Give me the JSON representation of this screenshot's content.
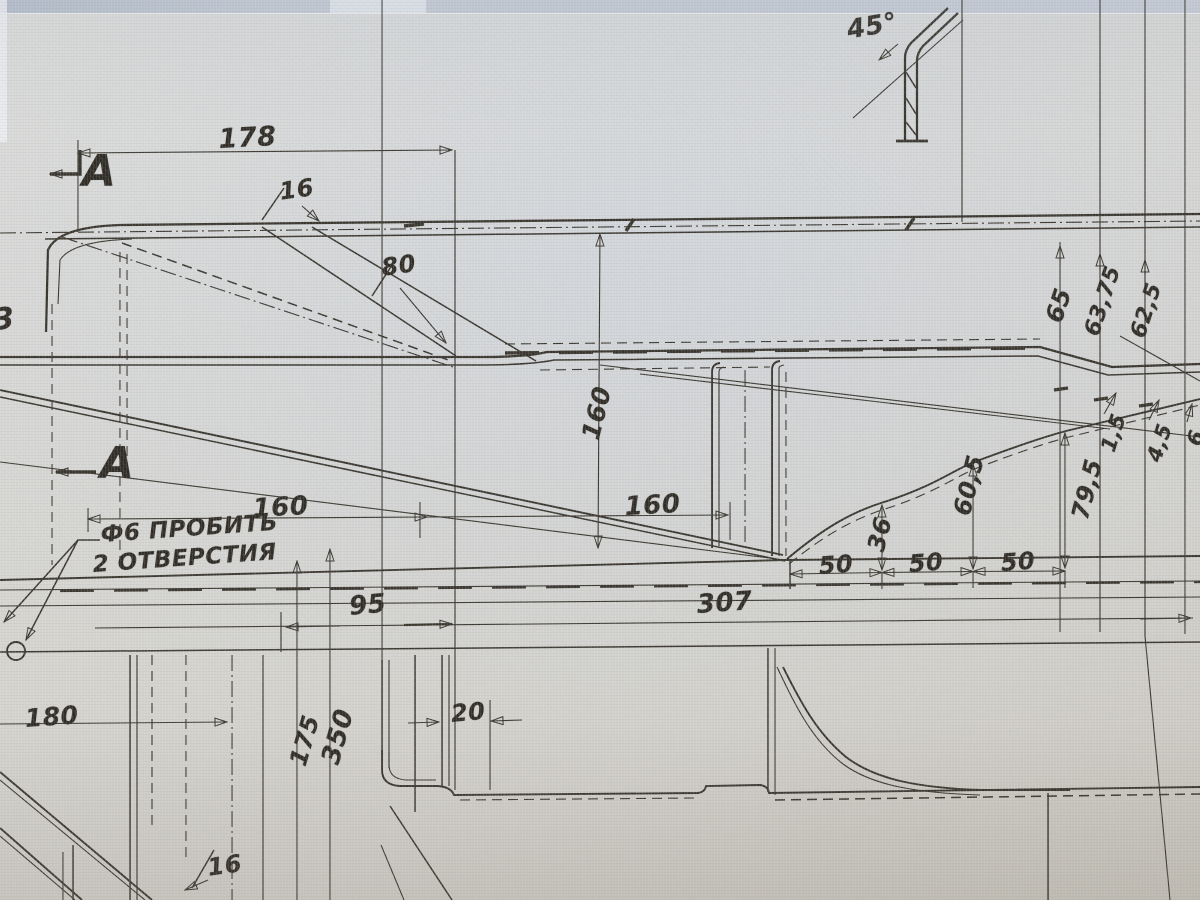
{
  "drawing": {
    "kind": "engineering-blueprint-photo",
    "note_line1": "Ф6 ПРОБИТЬ",
    "note_line2": "2 ОТВЕРСТИЯ",
    "section_label": "A",
    "angle_label": "45°"
  },
  "colors": {
    "paper": "#d8d7d2",
    "ink": "#39352d",
    "band": "#c2c9d2",
    "label": "#2f2b24"
  },
  "annotations": [
    {
      "text": "178",
      "x": 218,
      "y": 126,
      "rot": -3,
      "size": 27
    },
    {
      "text": "16",
      "x": 278,
      "y": 180,
      "rot": -8,
      "size": 24
    },
    {
      "text": "80",
      "x": 380,
      "y": 256,
      "rot": -8,
      "size": 24
    },
    {
      "text": "45°",
      "x": 845,
      "y": 18,
      "rot": -10,
      "size": 26
    },
    {
      "text": "A",
      "x": 82,
      "y": 150,
      "rot": 0,
      "size": 44,
      "bold": true
    },
    {
      "text": "A",
      "x": 100,
      "y": 442,
      "rot": 0,
      "size": 44,
      "bold": true
    },
    {
      "text": "3",
      "x": -8,
      "y": 306,
      "rot": -5,
      "size": 30
    },
    {
      "text": "160",
      "x": 578,
      "y": 436,
      "rot": -76,
      "size": 25
    },
    {
      "text": "160",
      "x": 252,
      "y": 496,
      "rot": -3,
      "size": 26
    },
    {
      "text": "160",
      "x": 624,
      "y": 494,
      "rot": -3,
      "size": 26
    },
    {
      "text": "Ф6 ПРОБИТЬ",
      "x": 100,
      "y": 524,
      "rot": -4,
      "size": 23
    },
    {
      "text": "2 ОТВЕРСТИЯ",
      "x": 92,
      "y": 554,
      "rot": -4,
      "size": 23
    },
    {
      "text": "50",
      "x": 818,
      "y": 554,
      "rot": -4,
      "size": 24
    },
    {
      "text": "50",
      "x": 908,
      "y": 552,
      "rot": -4,
      "size": 24
    },
    {
      "text": "50",
      "x": 1000,
      "y": 551,
      "rot": -4,
      "size": 24
    },
    {
      "text": "95",
      "x": 348,
      "y": 594,
      "rot": -5,
      "size": 26
    },
    {
      "text": "307",
      "x": 696,
      "y": 592,
      "rot": -4,
      "size": 26
    },
    {
      "text": "180",
      "x": 24,
      "y": 706,
      "rot": -4,
      "size": 25
    },
    {
      "text": "175",
      "x": 286,
      "y": 762,
      "rot": -74,
      "size": 24
    },
    {
      "text": "350",
      "x": 318,
      "y": 760,
      "rot": -74,
      "size": 26
    },
    {
      "text": "20",
      "x": 450,
      "y": 702,
      "rot": -5,
      "size": 24
    },
    {
      "text": "36",
      "x": 864,
      "y": 548,
      "rot": -76,
      "size": 24
    },
    {
      "text": "60,5",
      "x": 950,
      "y": 512,
      "rot": -76,
      "size": 24
    },
    {
      "text": "79,5",
      "x": 1068,
      "y": 516,
      "rot": -76,
      "size": 24
    },
    {
      "text": "65",
      "x": 1042,
      "y": 318,
      "rot": -72,
      "size": 24
    },
    {
      "text": "63,75",
      "x": 1082,
      "y": 332,
      "rot": -72,
      "size": 22
    },
    {
      "text": "62,5",
      "x": 1128,
      "y": 334,
      "rot": -72,
      "size": 22
    },
    {
      "text": "1,5",
      "x": 1098,
      "y": 448,
      "rot": -72,
      "size": 21
    },
    {
      "text": "4,5",
      "x": 1144,
      "y": 458,
      "rot": -72,
      "size": 21
    },
    {
      "text": "6",
      "x": 1184,
      "y": 442,
      "rot": -72,
      "size": 21
    },
    {
      "text": "16",
      "x": 206,
      "y": 856,
      "rot": -8,
      "size": 24
    }
  ]
}
